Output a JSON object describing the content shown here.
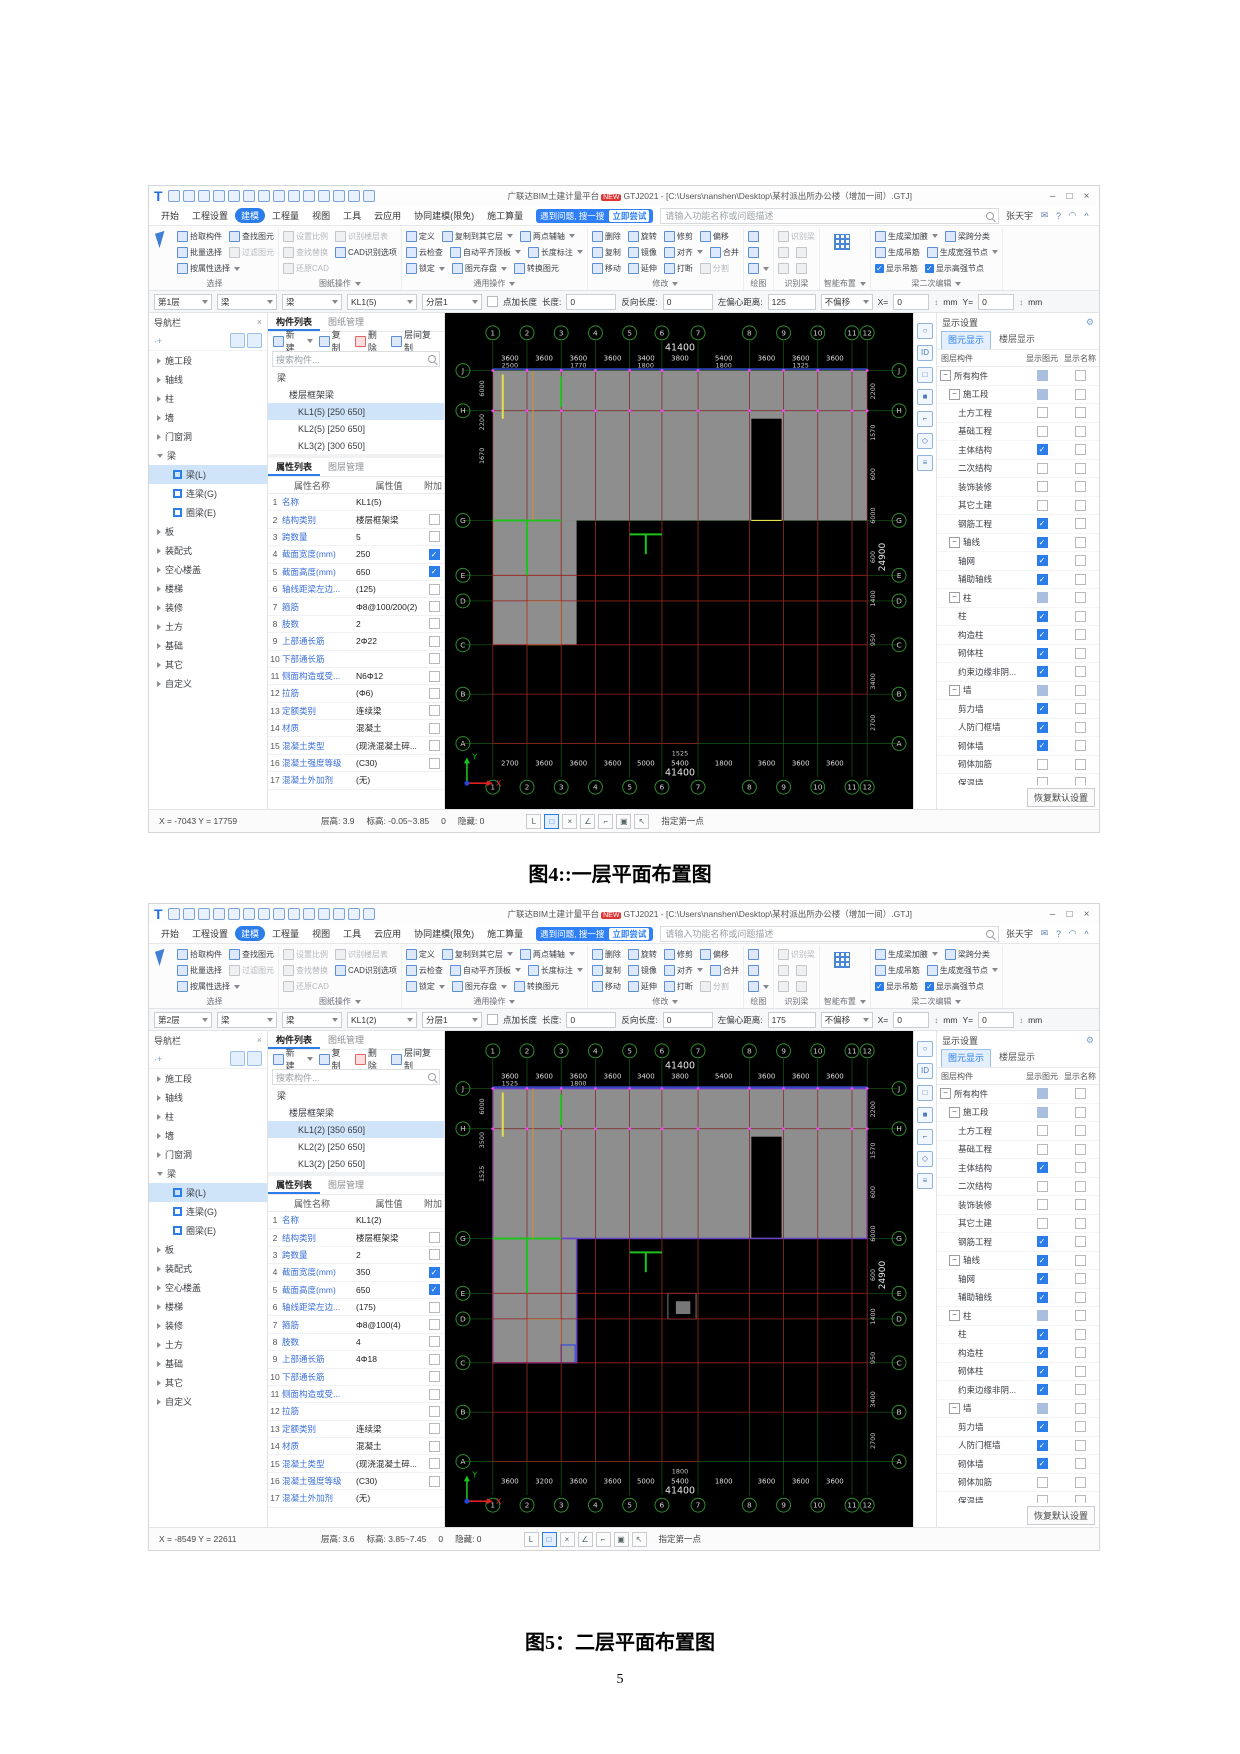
{
  "page": {
    "captions": {
      "fig4": "图4::一层平面布置图",
      "fig5": "图5：二层平面布置图"
    },
    "page_number": "5"
  },
  "app": {
    "logo": "T",
    "title": "广联达BIM土建计量平台",
    "badge": "NEW",
    "title2": "GTJ2021 - [C:\\Users\\nanshen\\Desktop\\某村派出所办公楼（增加一间）.GTJ]",
    "controls": {
      "min": "–",
      "max": "□",
      "close": "×"
    }
  },
  "titlebar_qat": [
    "project-icon",
    "new-icon",
    "open-icon",
    "save-icon",
    "undo-icon",
    "redo-icon",
    "sum-icon",
    "find-view-icon",
    "table-icon",
    "compare-icon",
    "markup-icon",
    "layout-icon",
    "sync-icon",
    "more-icon"
  ],
  "menu": {
    "tabs": [
      {
        "t": "开始"
      },
      {
        "t": "工程设置"
      },
      {
        "t": "建模",
        "active": true
      },
      {
        "t": "工程量"
      },
      {
        "t": "视图"
      },
      {
        "t": "工具"
      },
      {
        "t": "云应用"
      },
      {
        "t": "协同建模(限免)"
      },
      {
        "t": "施工算量"
      }
    ],
    "banner": {
      "text": "遇到问题, 搜一搜",
      "btn": "立即尝试"
    },
    "search_placeholder": "请输入功能名称或问题描述",
    "user": "张天宇",
    "icons": [
      {
        "n": "feedback-icon",
        "g": "✉"
      },
      {
        "n": "help-icon",
        "g": "?"
      },
      {
        "n": "skin-icon",
        "g": "◠"
      },
      {
        "n": "collapse-ribbon-icon",
        "g": "^"
      }
    ]
  },
  "ribbon": {
    "groups": [
      {
        "caption": "选择",
        "big": "cursor",
        "rows": [
          [
            {
              "t": "拾取构件"
            },
            {
              "t": "查找图元"
            }
          ],
          [
            {
              "t": "批量选择"
            },
            {
              "t": "过滤图元",
              "d": 1
            }
          ],
          [
            {
              "t": "按属性选择",
              "a": 1
            }
          ]
        ]
      },
      {
        "caption": "图纸操作",
        "ca": 1,
        "rows": [
          [
            {
              "t": "设置比例",
              "d": 1
            },
            {
              "t": "识别楼层表",
              "d": 1
            }
          ],
          [
            {
              "t": "查找替换",
              "d": 1
            },
            {
              "t": "CAD识别选项"
            }
          ],
          [
            {
              "t": "还原CAD",
              "d": 1
            }
          ]
        ]
      },
      {
        "caption": "通用操作",
        "ca": 1,
        "rows": [
          [
            {
              "t": "定义"
            },
            {
              "t": "复制到其它层",
              "a": 1
            },
            {
              "t": "两点辅轴",
              "a": 1
            }
          ],
          [
            {
              "t": "云检查"
            },
            {
              "t": "自动平齐顶板",
              "a": 1
            },
            {
              "t": "长度标注",
              "a": 1
            }
          ],
          [
            {
              "t": "锁定",
              "a": 1
            },
            {
              "t": "图元存盘",
              "a": 1
            },
            {
              "t": "转换图元"
            }
          ]
        ]
      },
      {
        "caption": "修改",
        "ca": 1,
        "rows": [
          [
            {
              "t": "删除"
            },
            {
              "t": "旋转"
            },
            {
              "t": "修剪"
            },
            {
              "t": "偏移"
            }
          ],
          [
            {
              "t": "复制"
            },
            {
              "t": "镜像"
            },
            {
              "t": "对齐",
              "a": 1
            },
            {
              "t": "合并"
            }
          ],
          [
            {
              "t": "移动"
            },
            {
              "t": "延伸"
            },
            {
              "t": "打断"
            },
            {
              "t": "分割",
              "d": 1
            }
          ]
        ]
      },
      {
        "caption": "绘图",
        "rows": [
          [
            {
              "t": ""
            }
          ],
          [
            {
              "t": ""
            }
          ],
          [
            {
              "t": "",
              "a": 1
            }
          ]
        ]
      },
      {
        "caption": "识别梁",
        "rows": [
          [
            {
              "t": "识别梁",
              "d": 1
            }
          ],
          [
            {
              "t": "",
              "d": 1
            },
            {
              "t": "",
              "d": 1
            }
          ],
          [
            {
              "t": "",
              "d": 1
            },
            {
              "t": "",
              "d": 1
            }
          ]
        ]
      },
      {
        "caption": "智能布置",
        "ca": 1,
        "big": "grid",
        "rows": []
      },
      {
        "caption": "梁二次编辑",
        "ca": 1,
        "rows": [
          [
            {
              "t": "生成梁加腋",
              "a": 1
            },
            {
              "t": "梁跨分类"
            }
          ],
          [
            {
              "t": "生成吊筋"
            },
            {
              "t": "生成宽强节点",
              "a": 1
            }
          ],
          [
            {
              "t": "显示吊筋",
              "k": 1
            },
            {
              "t": "显示高强节点",
              "k": 1
            }
          ]
        ]
      }
    ]
  },
  "nav": {
    "title": "导航栏",
    "items": [
      {
        "t": "施工段"
      },
      {
        "t": "轴线"
      },
      {
        "t": "柱"
      },
      {
        "t": "墙"
      },
      {
        "t": "门窗洞"
      },
      {
        "t": "梁",
        "open": 1
      },
      {
        "t": "梁(L)",
        "sub": 1,
        "sel": 1
      },
      {
        "t": "连梁(G)",
        "sub": 1
      },
      {
        "t": "圈梁(E)",
        "sub": 1
      },
      {
        "t": "板"
      },
      {
        "t": "装配式"
      },
      {
        "t": "空心楼盖"
      },
      {
        "t": "楼梯"
      },
      {
        "t": "装修"
      },
      {
        "t": "土方"
      },
      {
        "t": "基础"
      },
      {
        "t": "其它"
      },
      {
        "t": "自定义"
      }
    ]
  },
  "comp": {
    "tabs": [
      "构件列表",
      "图纸管理"
    ],
    "toolbar": [
      "新建",
      "复制",
      "删除",
      "层间复制"
    ],
    "more": "⋯",
    "search": "搜索构件..."
  },
  "props": {
    "tabs": [
      "属性列表",
      "图层管理"
    ],
    "headers": [
      "属性名称",
      "属性值",
      "附加"
    ]
  },
  "display": {
    "title": "显示设置",
    "tabs": [
      "图元显示",
      "楼层显示"
    ],
    "headers": [
      "图层构件",
      "显示图元",
      "显示名称"
    ],
    "footer": "恢复默认设置",
    "rows": [
      {
        "t": "所有构件",
        "lvl": 0,
        "g": 1,
        "s": "mixed"
      },
      {
        "t": "施工段",
        "lvl": 1,
        "g": 1,
        "s": "mixed"
      },
      {
        "t": "土方工程",
        "lvl": 2,
        "s": "off"
      },
      {
        "t": "基础工程",
        "lvl": 2,
        "s": "off"
      },
      {
        "t": "主体结构",
        "lvl": 2,
        "s": "on"
      },
      {
        "t": "二次结构",
        "lvl": 2,
        "s": "off"
      },
      {
        "t": "装饰装修",
        "lvl": 2,
        "s": "off"
      },
      {
        "t": "其它土建",
        "lvl": 2,
        "s": "off"
      },
      {
        "t": "钢筋工程",
        "lvl": 2,
        "s": "on"
      },
      {
        "t": "轴线",
        "lvl": 1,
        "g": 1,
        "s": "on"
      },
      {
        "t": "轴网",
        "lvl": 2,
        "s": "on"
      },
      {
        "t": "辅助轴线",
        "lvl": 2,
        "s": "on"
      },
      {
        "t": "柱",
        "lvl": 1,
        "g": 1,
        "s": "mixed"
      },
      {
        "t": "柱",
        "lvl": 2,
        "s": "on"
      },
      {
        "t": "构造柱",
        "lvl": 2,
        "s": "on"
      },
      {
        "t": "砌体柱",
        "lvl": 2,
        "s": "on"
      },
      {
        "t": "约束边缘非阴...",
        "lvl": 2,
        "s": "on"
      },
      {
        "t": "墙",
        "lvl": 1,
        "g": 1,
        "s": "mixed"
      },
      {
        "t": "剪力墙",
        "lvl": 2,
        "s": "on"
      },
      {
        "t": "人防门框墙",
        "lvl": 2,
        "s": "on"
      },
      {
        "t": "砌体墙",
        "lvl": 2,
        "s": "on"
      },
      {
        "t": "砌体加筋",
        "lvl": 2,
        "s": "off"
      },
      {
        "t": "保温墙",
        "lvl": 2,
        "s": "off"
      },
      {
        "t": "墙垛",
        "lvl": 2,
        "s": "off"
      }
    ]
  },
  "viewstrip": [
    {
      "n": "orbit-view-icon",
      "g": "○"
    },
    {
      "n": "id-view-icon",
      "g": "ID"
    },
    {
      "n": "view-cube-icon",
      "g": "□"
    },
    {
      "n": "solid-cube-icon",
      "g": "■"
    },
    {
      "n": "zoom-window-icon",
      "g": "⌐"
    },
    {
      "n": "entity-view-icon",
      "g": "◇"
    },
    {
      "n": "view-settings-icon",
      "g": "≡"
    }
  ],
  "status_icons": [
    {
      "n": "ortho-mode-icon",
      "g": "L"
    },
    {
      "n": "rect-select-icon",
      "g": "□",
      "active": 1
    },
    {
      "n": "cross-select-icon",
      "g": "×"
    },
    {
      "n": "angle-snap-icon",
      "g": "∠"
    },
    {
      "n": "polyline-mode-icon",
      "g": "⌐"
    },
    {
      "n": "object-snap-icon",
      "g": "▣"
    },
    {
      "n": "pick-mode-icon",
      "g": "↖"
    }
  ],
  "shots": {
    "s1": {
      "select": {
        "floor": "第1层",
        "cat": "梁",
        "sub": "梁",
        "comp": "KL1(5)",
        "layer": "分层1",
        "pt": "点加长度",
        "len_l": "长度:",
        "len": "0",
        "rev_l": "反向长度:",
        "rev": "0",
        "off_l": "左偏心距离:",
        "off": "125",
        "mode": "不偏移",
        "xl": "X=",
        "x": "0",
        "xu": "mm",
        "yl": "Y=",
        "y": "0",
        "yu": "mm"
      },
      "tree": [
        {
          "t": "梁",
          "lvl": 0,
          "car": 1
        },
        {
          "t": "楼层框架梁",
          "lvl": 1,
          "car": 1
        },
        {
          "t": "KL1(5) [250 650]",
          "lvl": 2,
          "sel": 1
        },
        {
          "t": "KL2(5) [250 650]",
          "lvl": 2
        },
        {
          "t": "KL3(2) [300 650]",
          "lvl": 2
        }
      ],
      "prows": [
        {
          "n": "1",
          "a": "名称",
          "v": "KL1(5)",
          "c": "none"
        },
        {
          "n": "2",
          "a": "结构类别",
          "v": "楼层框架梁",
          "c": "off"
        },
        {
          "n": "3",
          "a": "跨数量",
          "v": "5",
          "c": "off"
        },
        {
          "n": "4",
          "a": "截面宽度(mm)",
          "v": "250",
          "c": "on"
        },
        {
          "n": "5",
          "a": "截面高度(mm)",
          "v": "650",
          "c": "on"
        },
        {
          "n": "6",
          "a": "轴线距梁左边...",
          "v": "(125)",
          "c": "off"
        },
        {
          "n": "7",
          "a": "箍筋",
          "v": "Φ8@100/200(2)",
          "c": "off"
        },
        {
          "n": "8",
          "a": "肢数",
          "v": "2",
          "c": "off"
        },
        {
          "n": "9",
          "a": "上部通长筋",
          "v": "2Φ22",
          "c": "off"
        },
        {
          "n": "10",
          "a": "下部通长筋",
          "v": "",
          "c": "off"
        },
        {
          "n": "11",
          "a": "侧面构造或受...",
          "v": "N6Φ12",
          "c": "off"
        },
        {
          "n": "12",
          "a": "拉筋",
          "v": "(Φ6)",
          "c": "off"
        },
        {
          "n": "13",
          "a": "定额类别",
          "v": "连续梁",
          "c": "off"
        },
        {
          "n": "14",
          "a": "材质",
          "v": "混凝土",
          "c": "off"
        },
        {
          "n": "15",
          "a": "混凝土类型",
          "v": "(现浇混凝土碎...",
          "c": "off"
        },
        {
          "n": "16",
          "a": "混凝土强度等级",
          "v": "(C30)",
          "c": "off"
        },
        {
          "n": "17",
          "a": "混凝土外加剂",
          "v": "(无)",
          "c": "none"
        }
      ],
      "status": {
        "coords": "X = -7043 Y = 17759",
        "fh": "层高: 3.9",
        "el": "标高: -0.05~3.85",
        "zero": "0",
        "hid": "隐藏: 0",
        "prompt": "指定第一点"
      },
      "variant": "v1",
      "canvas": {
        "cols": [
          "1",
          "2",
          "3",
          "4",
          "5",
          "6",
          "7",
          "8",
          "9",
          "10",
          "11",
          "12"
        ],
        "rows": [
          "J",
          "H",
          "G",
          "E",
          "D",
          "C",
          "B",
          "A"
        ],
        "top_total": "41400",
        "top_dims": [
          "3600",
          "3600",
          "3600",
          "3600",
          "3400",
          "3800",
          "5400",
          "3600",
          "3600",
          "3600"
        ],
        "top_extra": [
          "2500",
          "1770",
          "1800",
          "1800",
          "1325"
        ],
        "bottom_dims": [
          "2700",
          "3600",
          "3600",
          "3600",
          "5000",
          "5400",
          "1800",
          "3600",
          "3600",
          "3600"
        ],
        "bottom_total": "41400",
        "bottom_extra": [
          "1525"
        ],
        "right_total": "24900",
        "right_dims": [
          "2200",
          "1570",
          "600",
          "6000",
          "600",
          "1400",
          "950",
          "3400",
          "2700"
        ],
        "left_dims": [
          "6000",
          "2200",
          "1670"
        ],
        "axis": {
          "x": "X",
          "y": "Y"
        }
      }
    },
    "s2": {
      "select": {
        "floor": "第2层",
        "cat": "梁",
        "sub": "梁",
        "comp": "KL1(2)",
        "layer": "分层1",
        "pt": "点加长度",
        "len_l": "长度:",
        "len": "0",
        "rev_l": "反向长度:",
        "rev": "0",
        "off_l": "左偏心距离:",
        "off": "175",
        "mode": "不偏移",
        "xl": "X=",
        "x": "0",
        "xu": "mm",
        "yl": "Y=",
        "y": "0",
        "yu": "mm"
      },
      "tree": [
        {
          "t": "梁",
          "lvl": 0,
          "car": 1
        },
        {
          "t": "楼层框架梁",
          "lvl": 1,
          "car": 1
        },
        {
          "t": "KL1(2) [350 650]",
          "lvl": 2,
          "sel": 1
        },
        {
          "t": "KL2(2) [250 650]",
          "lvl": 2
        },
        {
          "t": "KL3(2) [250 650]",
          "lvl": 2
        }
      ],
      "prows": [
        {
          "n": "1",
          "a": "名称",
          "v": "KL1(2)",
          "c": "none"
        },
        {
          "n": "2",
          "a": "结构类别",
          "v": "楼层框架梁",
          "c": "off"
        },
        {
          "n": "3",
          "a": "跨数量",
          "v": "2",
          "c": "off"
        },
        {
          "n": "4",
          "a": "截面宽度(mm)",
          "v": "350",
          "c": "on"
        },
        {
          "n": "5",
          "a": "截面高度(mm)",
          "v": "650",
          "c": "on"
        },
        {
          "n": "6",
          "a": "轴线距梁左边...",
          "v": "(175)",
          "c": "off"
        },
        {
          "n": "7",
          "a": "箍筋",
          "v": "Φ8@100(4)",
          "c": "off"
        },
        {
          "n": "8",
          "a": "肢数",
          "v": "4",
          "c": "off"
        },
        {
          "n": "9",
          "a": "上部通长筋",
          "v": "4Φ18",
          "c": "off"
        },
        {
          "n": "10",
          "a": "下部通长筋",
          "v": "",
          "c": "off"
        },
        {
          "n": "11",
          "a": "侧面构造或受...",
          "v": "",
          "c": "off"
        },
        {
          "n": "12",
          "a": "拉筋",
          "v": "",
          "c": "off"
        },
        {
          "n": "13",
          "a": "定额类别",
          "v": "连续梁",
          "c": "off"
        },
        {
          "n": "14",
          "a": "材质",
          "v": "混凝土",
          "c": "off"
        },
        {
          "n": "15",
          "a": "混凝土类型",
          "v": "(现浇混凝土碎...",
          "c": "off"
        },
        {
          "n": "16",
          "a": "混凝土强度等级",
          "v": "(C30)",
          "c": "off"
        },
        {
          "n": "17",
          "a": "混凝土外加剂",
          "v": "(无)",
          "c": "none"
        }
      ],
      "status": {
        "coords": "X = -8549 Y = 22611",
        "fh": "层高: 3.6",
        "el": "标高: 3.85~7.45",
        "zero": "0",
        "hid": "隐藏: 0",
        "prompt": "指定第一点"
      },
      "variant": "v2",
      "canvas": {
        "cols": [
          "1",
          "2",
          "3",
          "4",
          "5",
          "6",
          "7",
          "8",
          "9",
          "10",
          "11",
          "12"
        ],
        "rows": [
          "J",
          "H",
          "G",
          "E",
          "D",
          "C",
          "B",
          "A"
        ],
        "top_total": "41400",
        "top_dims": [
          "3600",
          "3600",
          "3600",
          "3600",
          "3400",
          "3800",
          "5400",
          "3600",
          "3600",
          "3600"
        ],
        "top_extra": [
          "1525",
          "1800"
        ],
        "bottom_dims": [
          "3600",
          "3200",
          "3600",
          "3600",
          "5000",
          "5400",
          "1800",
          "3600",
          "3600",
          "3600"
        ],
        "bottom_total": "41400",
        "bottom_extra": [
          "1800"
        ],
        "right_total": "24900",
        "right_dims": [
          "2200",
          "1570",
          "600",
          "6000",
          "600",
          "1400",
          "950",
          "3400",
          "2700"
        ],
        "left_dims": [
          "6000",
          "3500",
          "1525"
        ],
        "axis": {
          "x": "X",
          "y": "Y"
        }
      }
    }
  }
}
